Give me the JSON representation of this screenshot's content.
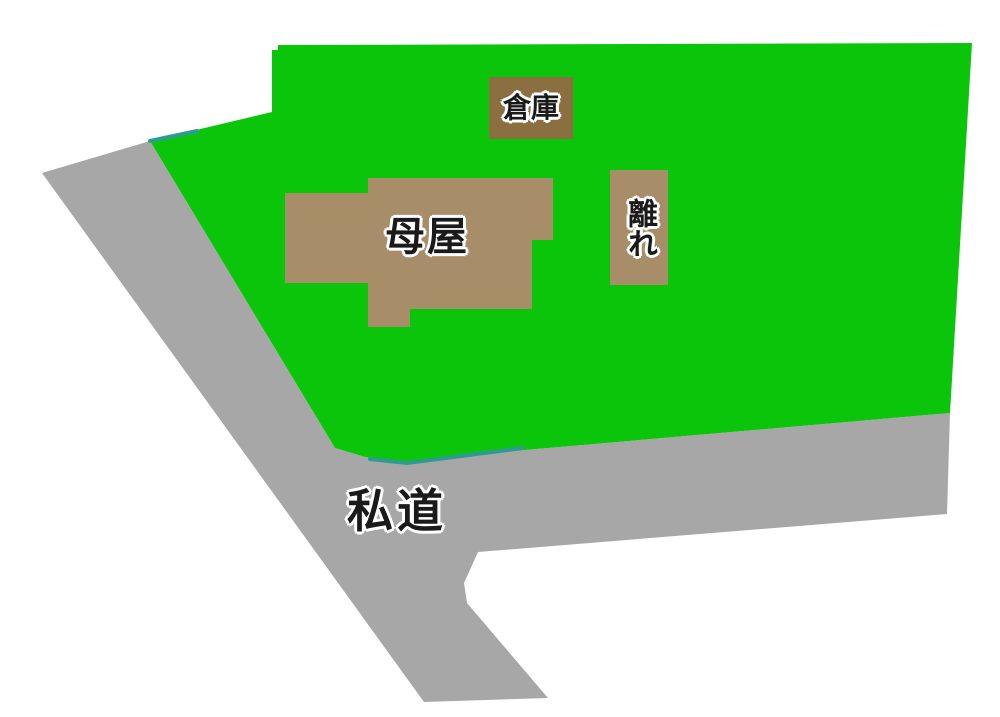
{
  "diagram": {
    "type": "site-plan",
    "labels": {
      "warehouse": "倉庫",
      "main_house": "母屋",
      "annex": "離れ",
      "private_road": "私道"
    },
    "colors": {
      "background": "#FFFFFF",
      "plot_green": "#0BC50B",
      "road_gray": "#A7A7A7",
      "house_brown": "#A78E69",
      "warehouse_brown": "#8C6F41",
      "boundary_teal": "#2D9C8F",
      "label_text": "#1A1A1A",
      "label_outline": "#FFFFFF"
    }
  }
}
